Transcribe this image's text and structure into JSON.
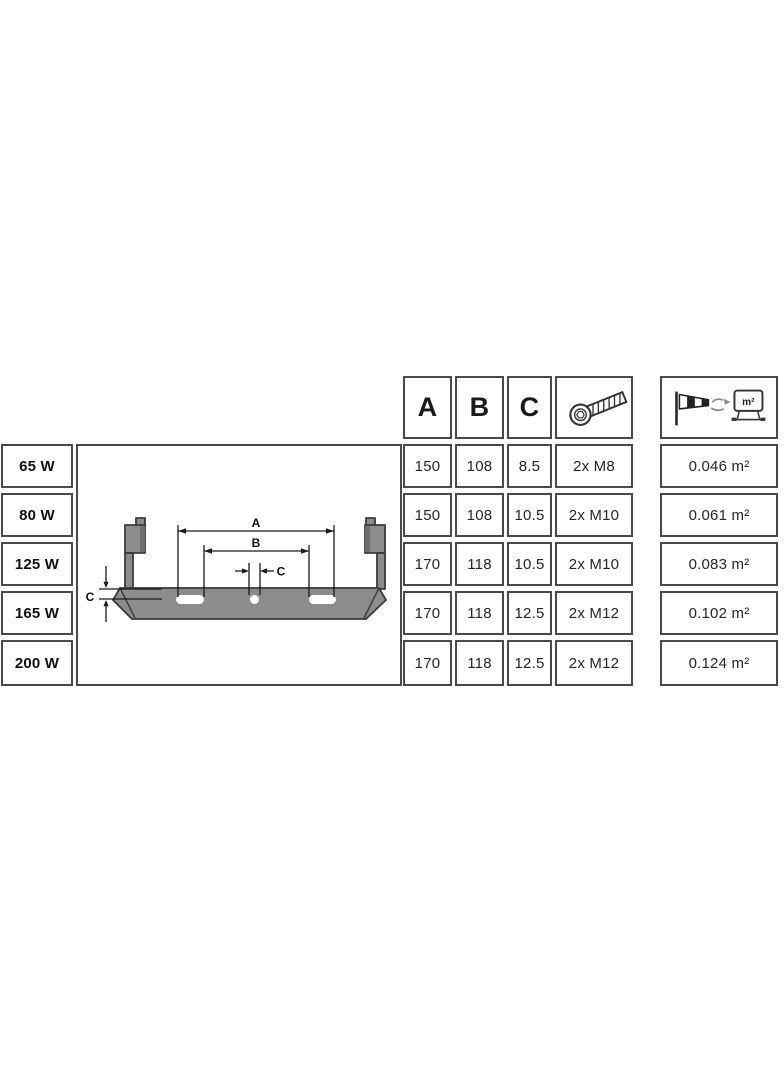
{
  "header": {
    "col_a": "A",
    "col_b": "B",
    "col_c": "C",
    "screw_icon": "hex-socket-screw-icon",
    "wind_icon": "windsock-wind-load-area-icon",
    "wind_icon_label": "m²"
  },
  "diagram": {
    "dim_a_label": "A",
    "dim_b_label": "B",
    "dim_c_hole_label": "C",
    "dim_c_thickness_label": "C"
  },
  "rows": [
    {
      "wattage": "65 W",
      "a": "150",
      "b": "108",
      "c": "8.5",
      "screws": "2x M8",
      "wind_area": "0.046 m²"
    },
    {
      "wattage": "80 W",
      "a": "150",
      "b": "108",
      "c": "10.5",
      "screws": "2x M10",
      "wind_area": "0.061 m²"
    },
    {
      "wattage": "125 W",
      "a": "170",
      "b": "118",
      "c": "10.5",
      "screws": "2x M10",
      "wind_area": "0.083 m²"
    },
    {
      "wattage": "165 W",
      "a": "170",
      "b": "118",
      "c": "12.5",
      "screws": "2x M12",
      "wind_area": "0.102 m²"
    },
    {
      "wattage": "200 W",
      "a": "170",
      "b": "118",
      "c": "12.5",
      "screws": "2x M12",
      "wind_area": "0.124 m²"
    }
  ],
  "colors": {
    "border": "#4a4a4a",
    "text": "#262626",
    "bracket_fill": "#8c8c8c",
    "bracket_edge": "#3b3b3b",
    "dimension_line": "#1a1a1a"
  }
}
